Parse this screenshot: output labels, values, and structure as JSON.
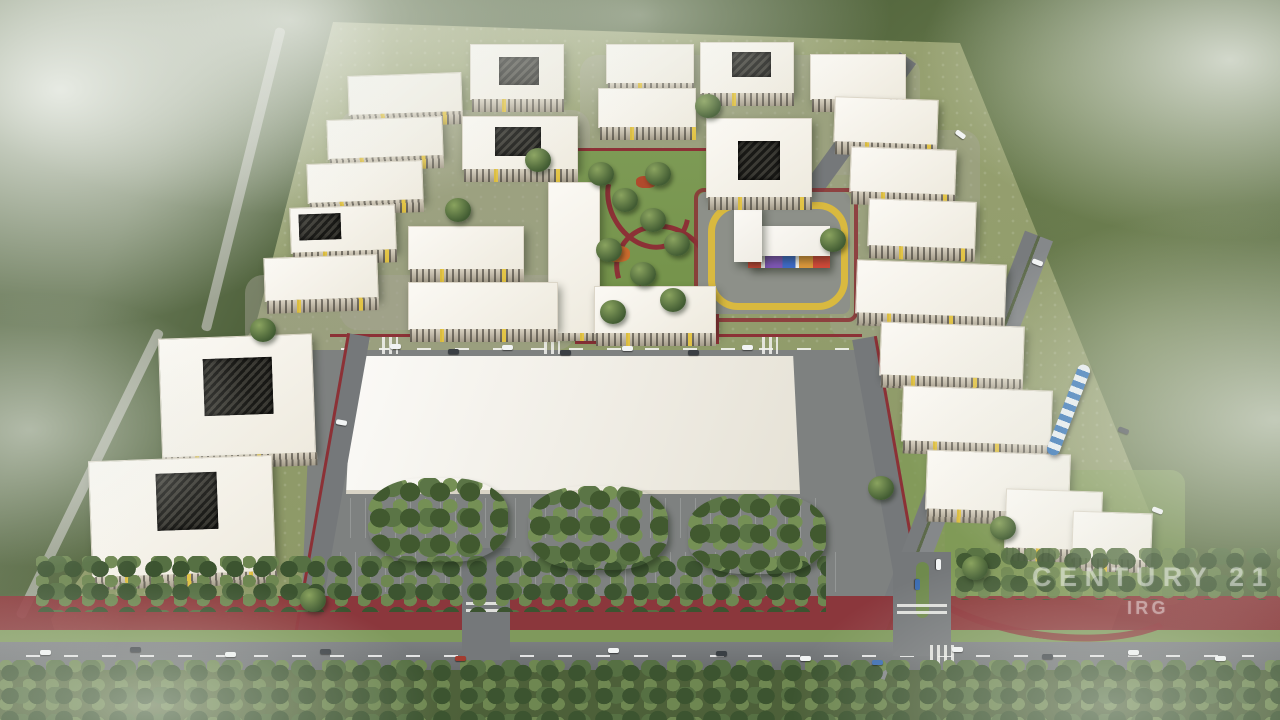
{
  "scene": {
    "type": "aerial-architectural-render",
    "title": "Residential masterplan surrounded by forest",
    "watermark": {
      "brand": "CENTURY 21",
      "agency": "IRG"
    },
    "palette": {
      "forest_dark": "#2f4228",
      "forest_mid": "#4c613c",
      "forest_light": "#7c9258",
      "fog": "#edf0ea",
      "site_grass": "#8e9a68",
      "paving": "#a6a597",
      "road": "#75787a",
      "path_red": "#8c3136",
      "roof_white": "#f6f4ef",
      "facade": "#cfc8b6",
      "accent_yellow": "#e6c53c",
      "court_dark": "#24241f",
      "kg_red": "#d44a3a",
      "kg_purple": "#8058b8",
      "kg_blue": "#3f6cc9",
      "kg_orange": "#e09a3c",
      "track_yellow": "#d9b93f",
      "tram_blue": "#2e6fb5",
      "car_white": "#f2f4f4",
      "car_dark": "#3a3f44"
    }
  }
}
